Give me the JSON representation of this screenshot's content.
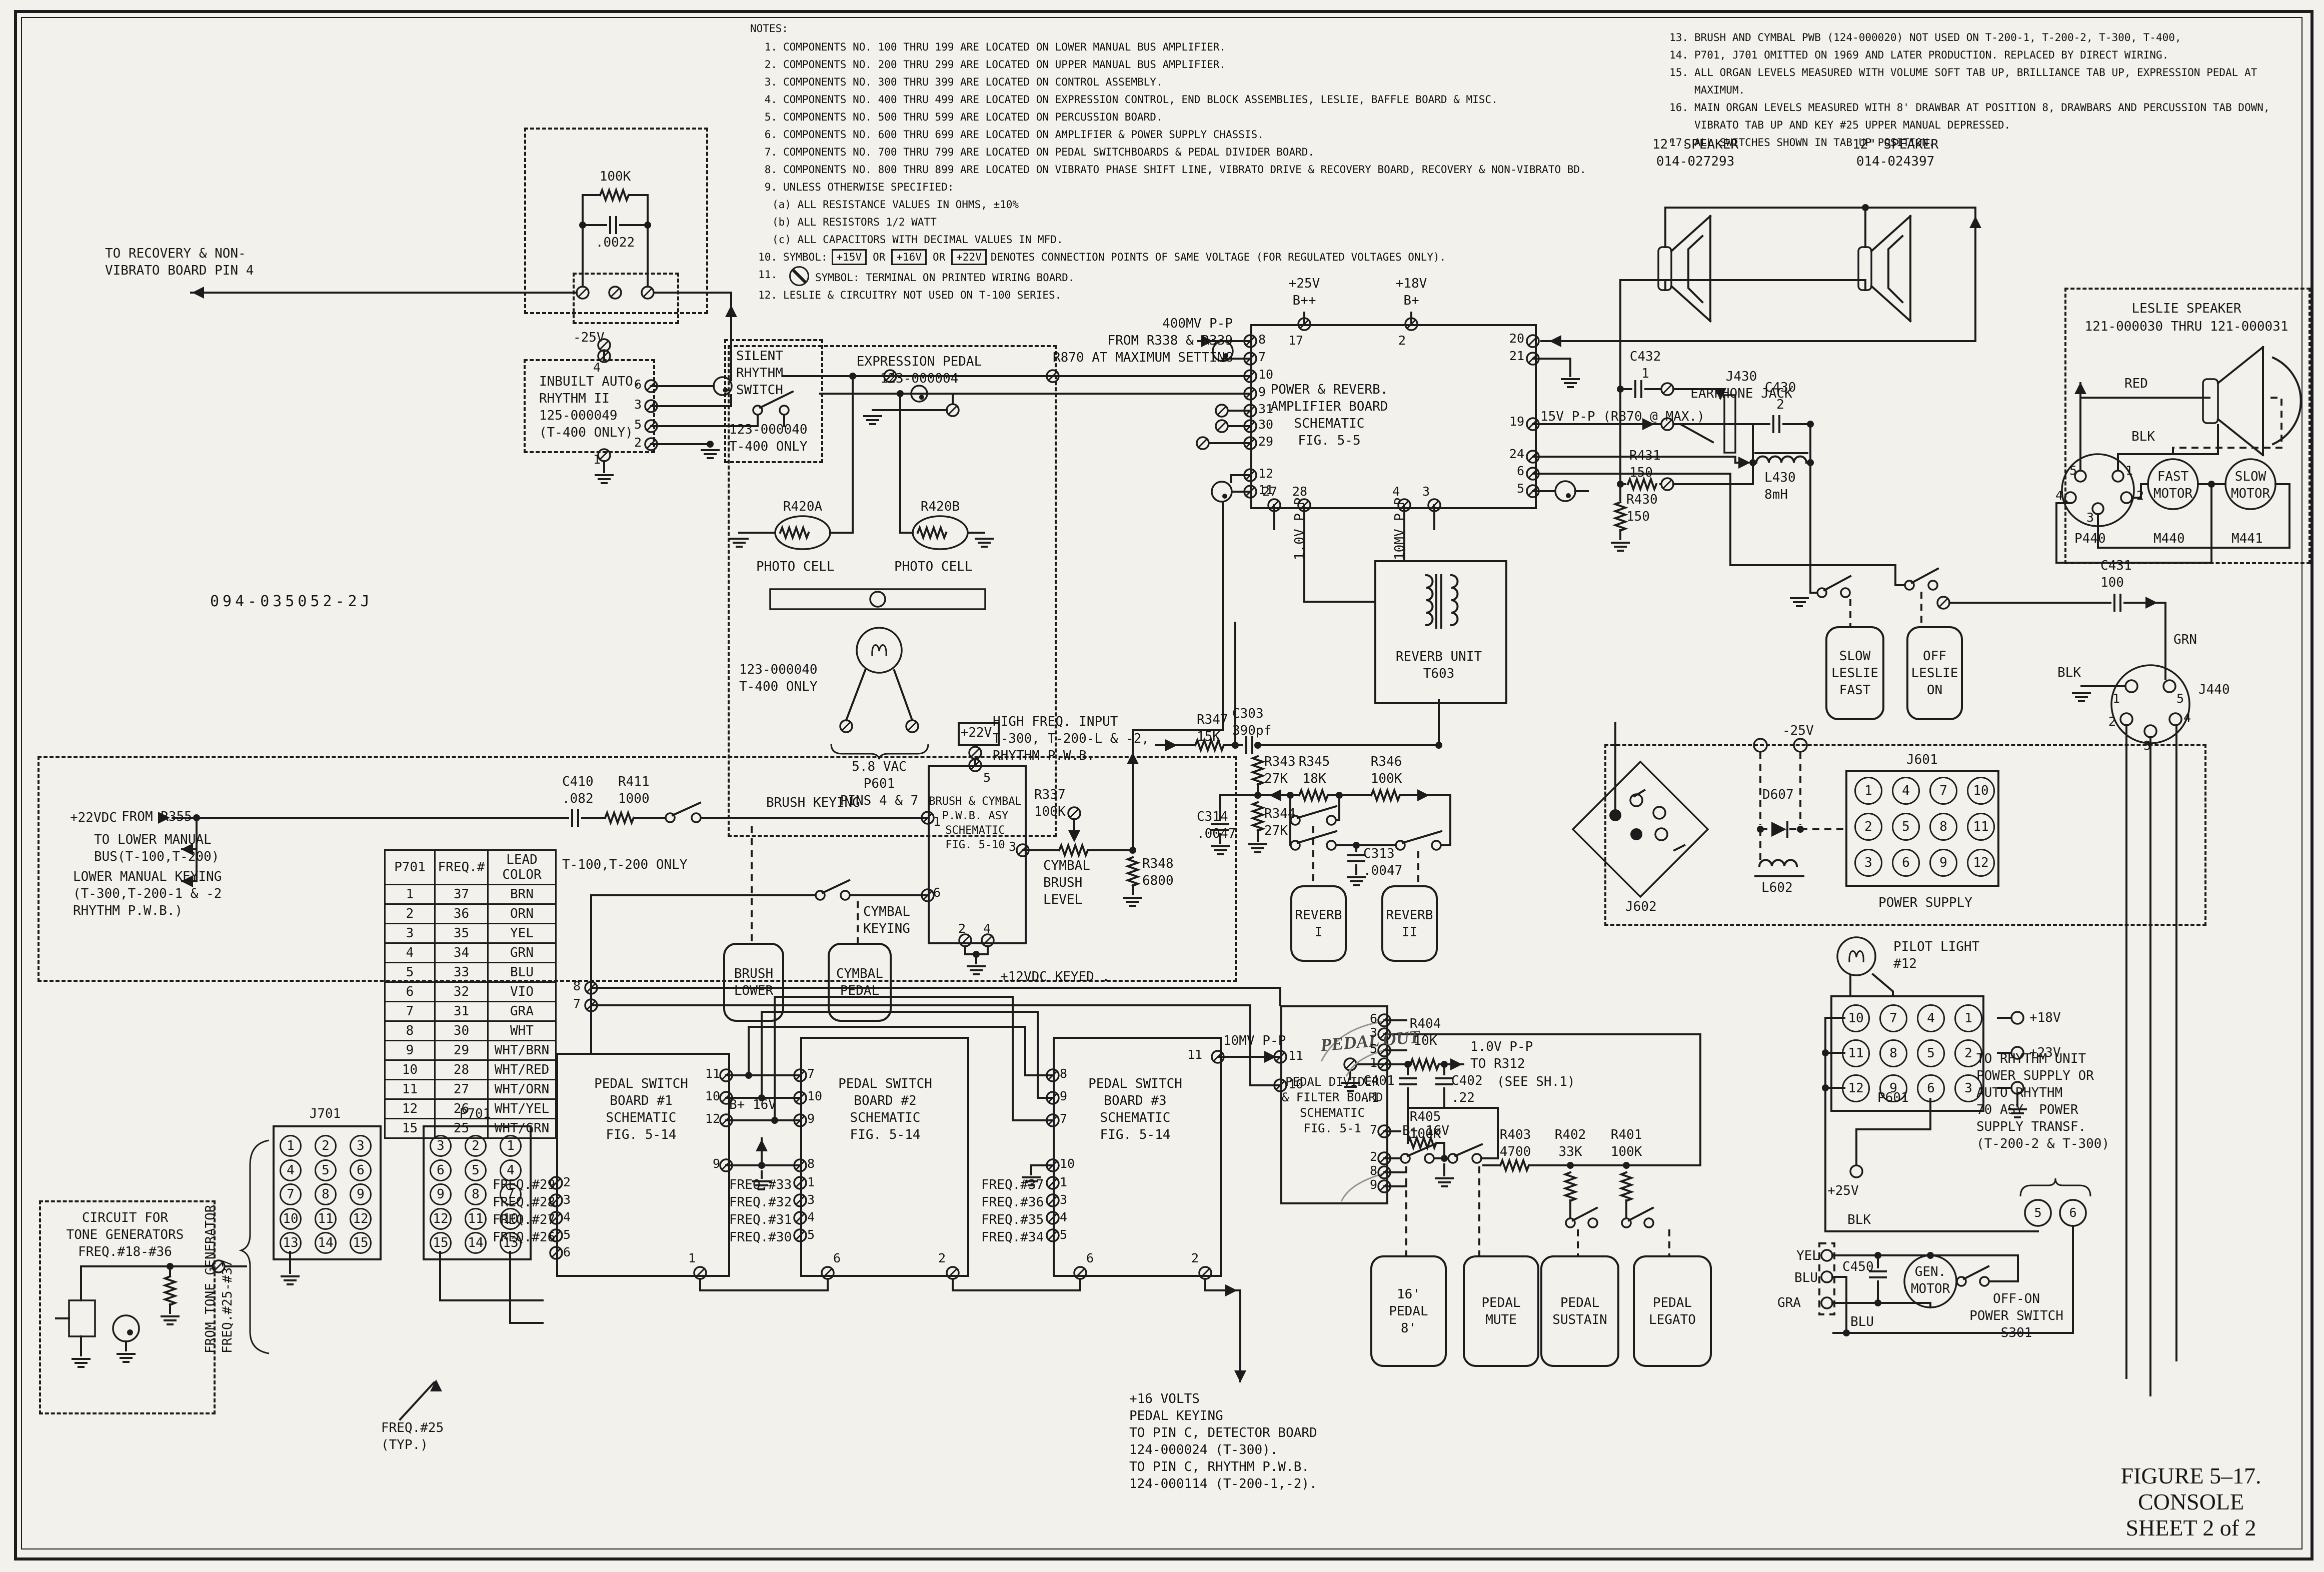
{
  "title_block": {
    "figure": "FIGURE 5–17.",
    "name": "CONSOLE",
    "sheet": "SHEET 2 of 2"
  },
  "drawing_number": "094-035052-2J",
  "notes": {
    "heading": "NOTES:",
    "left": [
      {
        "n": "1.",
        "t": "COMPONENTS NO. 100 THRU 199 ARE LOCATED ON LOWER MANUAL BUS AMPLIFIER."
      },
      {
        "n": "2.",
        "t": "COMPONENTS NO. 200 THRU 299 ARE LOCATED ON UPPER MANUAL BUS AMPLIFIER."
      },
      {
        "n": "3.",
        "t": "COMPONENTS NO. 300 THRU 399 ARE LOCATED ON CONTROL ASSEMBLY."
      },
      {
        "n": "4.",
        "t": "COMPONENTS NO. 400 THRU 499 ARE LOCATED ON EXPRESSION CONTROL, END BLOCK ASSEMBLIES, LESLIE, BAFFLE BOARD & MISC."
      },
      {
        "n": "5.",
        "t": "COMPONENTS NO. 500 THRU 599 ARE LOCATED ON PERCUSSION BOARD."
      },
      {
        "n": "6.",
        "t": "COMPONENTS NO. 600 THRU 699 ARE LOCATED ON AMPLIFIER & POWER SUPPLY CHASSIS."
      },
      {
        "n": "7.",
        "t": "COMPONENTS NO. 700 THRU 799 ARE LOCATED ON PEDAL SWITCHBOARDS & PEDAL DIVIDER BOARD."
      },
      {
        "n": "8.",
        "t": "COMPONENTS NO. 800 THRU 899 ARE LOCATED ON VIBRATO PHASE SHIFT LINE, VIBRATO DRIVE & RECOVERY BOARD, RECOVERY & NON-VIBRATO BD."
      },
      {
        "n": "9.",
        "t": "UNLESS OTHERWISE SPECIFIED:",
        "subs": [
          "(a) ALL RESISTANCE VALUES IN OHMS, ±10%",
          "(b) ALL RESISTORS 1/2 WATT",
          "(c) ALL CAPACITORS WITH DECIMAL VALUES IN MFD."
        ]
      },
      {
        "n": "10.",
        "t": "SYMBOL:",
        "boxed": [
          "+15V",
          "+16V",
          "+22V"
        ],
        "sep": "OR",
        "post": "DENOTES CONNECTION POINTS OF SAME VOLTAGE (FOR REGULATED VOLTAGES ONLY)."
      },
      {
        "n": "11.",
        "sym": true,
        "post": "SYMBOL: TERMINAL ON PRINTED WIRING BOARD."
      },
      {
        "n": "12.",
        "t": "LESLIE & CIRCUITRY NOT USED ON T-100 SERIES."
      }
    ],
    "right": [
      {
        "n": "13.",
        "t": "BRUSH AND CYMBAL PWB (124-000020) NOT USED ON T-200-1, T-200-2, T-300, T-400,"
      },
      {
        "n": "14.",
        "t": "P701, J701 OMITTED ON 1969 AND LATER PRODUCTION.  REPLACED BY DIRECT WIRING."
      },
      {
        "n": "15.",
        "t": "ALL ORGAN LEVELS MEASURED WITH VOLUME SOFT TAB UP, BRILLIANCE TAB UP, EXPRESSION PEDAL AT MAXIMUM."
      },
      {
        "n": "16.",
        "t": "MAIN ORGAN LEVELS MEASURED WITH 8' DRAWBAR AT POSITION 8, DRAWBARS AND PERCUSSION TAB DOWN,\nVIBRATO TAB UP AND KEY #25 UPPER MANUAL DEPRESSED."
      },
      {
        "n": "17.",
        "t": "ALL SWITCHES SHOWN IN TAB UP POSITION."
      }
    ]
  },
  "freq_table": {
    "headers": [
      "P701",
      "FREQ.#",
      "LEAD\nCOLOR"
    ],
    "rows": [
      [
        "1",
        "37",
        "BRN"
      ],
      [
        "2",
        "36",
        "ORN"
      ],
      [
        "3",
        "35",
        "YEL"
      ],
      [
        "4",
        "34",
        "GRN"
      ],
      [
        "5",
        "33",
        "BLU"
      ],
      [
        "6",
        "32",
        "VIO"
      ],
      [
        "7",
        "31",
        "GRA"
      ],
      [
        "8",
        "30",
        "WHT"
      ],
      [
        "9",
        "29",
        "WHT/BRN"
      ],
      [
        "10",
        "28",
        "WHT/RED"
      ],
      [
        "11",
        "27",
        "WHT/ORN"
      ],
      [
        "12",
        "26",
        "WHT/YEL"
      ],
      [
        "15",
        "25",
        "WHT/GRN"
      ]
    ]
  },
  "connectors": {
    "j701": {
      "rows": [
        [
          "1",
          "2",
          "3"
        ],
        [
          "4",
          "5",
          "6"
        ],
        [
          "7",
          "8",
          "9"
        ],
        [
          "10",
          "11",
          "12"
        ],
        [
          "13",
          "14",
          "15"
        ]
      ]
    },
    "p701": {
      "rows": [
        [
          "3",
          "2",
          "1"
        ],
        [
          "6",
          "5",
          "4"
        ],
        [
          "9",
          "8",
          "7"
        ],
        [
          "12",
          "11",
          "10"
        ],
        [
          "15",
          "14",
          "13"
        ]
      ]
    },
    "j601": {
      "rows": [
        [
          "1",
          "4",
          "7",
          "10"
        ],
        [
          "2",
          "5",
          "8",
          "11"
        ],
        [
          "3",
          "6",
          "9",
          "12"
        ]
      ]
    },
    "p601": {
      "rows": [
        [
          "10",
          "7",
          "4",
          "1"
        ],
        [
          "11",
          "8",
          "5",
          "2"
        ],
        [
          "12",
          "9",
          "6",
          "3"
        ]
      ]
    }
  },
  "labels": {
    "sp1": "12\" SPEAKER\n014-027293",
    "sp2": "12\" SPEAKER\n014-024397",
    "leslie1": "LESLIE SPEAKER",
    "leslie2": "121-000030 THRU 121-000031",
    "red": "RED",
    "blk_a": "BLK",
    "p440": "P440",
    "m440": "M440",
    "m441": "M441",
    "fastm": "FAST\nMOTOR",
    "slowm": "SLOW\nMOTOR",
    "r100k": "100K",
    "c0022": ".0022",
    "torec": "TO RECOVERY & NON-\nVIBRATO BOARD PIN 4",
    "n25a": "-25V",
    "inbuilt": "INBUILT AUTO.\nRHYTHM II\n125-000049\n(T-400 ONLY)",
    "silent": "SILENT\nRHYTHM\nSWITCH",
    "silentpn": "123-000040\nT-400 ONLY",
    "expr": "EXPRESSION PEDAL\n123-000004",
    "r420a": "R420A",
    "r420b": "R420B",
    "pc1": "PHOTO CELL",
    "pc2": "PHOTO CELL",
    "exppn": "123-000040\nT-400 ONLY",
    "vac": "5.8 VAC\nP601\nPINS 4 & 7",
    "dwg": "094-035052-2J",
    "mv400": "400MV P-P\nFROM R338 & R339\nR870 AT MAXIMUM SETTING",
    "b1": "+25V\nB++",
    "b2": "+18V\nB+",
    "pamp": "POWER & REVERB.\nAMPLIFIER BOARD\nSCHEMATIC\nFIG. 5-5",
    "v15": "15V P-P (R870 @ MAX.)",
    "c432": "C432\n1",
    "j430": "J430\nEARPHONE JACK",
    "c430": "C430\n2",
    "r431": "R431\n150",
    "r430": "R430\n150",
    "l430": "L430\n8mH",
    "hfi": "HIGH FREQ. INPUT\nT-300, T-200-L & -2,\nRHYTHM P.W.B.",
    "r347": "R347\n15K",
    "c303": "C303\n390pf",
    "r343": "R343\n27K",
    "c314": "C314\n.0047",
    "r344": "R344\n27K",
    "r345": "R345\n18K",
    "r346": "R346\n100K",
    "c313": "C313\n.0047",
    "rev1": "REVERB\nI",
    "rev2": "REVERB\nII",
    "revu": "REVERB UNIT\nT603",
    "v10a": "1.0V P-P",
    "v10b": "10MV P-P",
    "slowl": "SLOW\nLESLIE\nFAST",
    "offl": "OFF\nLESLIE\nON",
    "c431": "C431\n100",
    "grn": "GRN",
    "blk_b": "BLK",
    "j440": "J440",
    "n25b": "-25V",
    "j602": "J602",
    "d607": "D607",
    "l602": "L602",
    "j601": "J601",
    "psup": "POWER SUPPLY",
    "pilot": "PILOT LIGHT\n#12",
    "p601": "P601",
    "p18": "+18V",
    "p23": "+23V",
    "p25": "+25V",
    "torhy": "TO RHYTHM UNIT\nPOWER SUPPLY OR\nAUTO RHYTHM\n70 ASY  POWER\nSUPPLY TRANSF.\n(T-200-2 & T-300)",
    "blk_c": "BLK",
    "yel": "YEL",
    "blu_a": "BLU",
    "gra": "GRA",
    "blu_b": "BLU",
    "c450": "C450",
    "genm": "GEN.\nMOTOR",
    "offon": "OFF-ON\nPOWER SWITCH\nS301",
    "p22vdc": "+22VDC",
    "fr355": "FROM R355",
    "tolm": "TO LOWER MANUAL\nBUS(T-100,T-200)",
    "lmk": "LOWER MANUAL KEYING\n(T-300,T-200-1 & -2\nRHYTHM P.W.B.)",
    "c410": "C410\n.082",
    "r411": "R411\n1000",
    "bkey": "BRUSH KEYING",
    "t100": "T-100,T-200 ONLY",
    "bc": "BRUSH & CYMBAL\nP.W.B. ASY\nSCHEMATIC\nFIG. 5-10",
    "v22box": "+22V",
    "blower": "BRUSH\nLOWER",
    "cpedal": "CYMBAL\nPEDAL",
    "ckey": "CYMBAL\nKEYING",
    "r337": "R337\n100K",
    "cbl": "CYMBAL\nBRUSH\nLEVEL",
    "r348": "R348\n6800",
    "v12k": "+12VDC KEYED .",
    "psb1": "PEDAL SWITCH\nBOARD #1\nSCHEMATIC\nFIG. 5-14",
    "psb2": "PEDAL SWITCH\nBOARD #2\nSCHEMATIC\nFIG. 5-14",
    "psb3": "PEDAL SWITCH\nBOARD #3\nSCHEMATIC\nFIG. 5-14",
    "b16a": "B+ 16V",
    "b16b": "B+ 16V",
    "mv10": "10MV P-P",
    "pdiv": "PEDAL DIVIDER\n& FILTER BOARD\nSCHEMATIC\nFIG. 5-1",
    "pout": "PEDAL OUT",
    "r404": "R404\n10K",
    "v1r312": "1.0V P-P\nTO R312",
    "sh1": "(SEE SH.1)",
    "c401": "C401\n.1",
    "c402": "C402\n.22",
    "r405": "R405\n100K",
    "p16b": "16'\nPEDAL\n8'",
    "pmute": "PEDAL\nMUTE",
    "r403": "R403\n4700",
    "r402": "R402\n33K",
    "r401": "R401\n100K",
    "psus": "PEDAL\nSUSTAIN",
    "pleg": "PEDAL\nLEGATO",
    "v16n": "+16 VOLTS\nPEDAL KEYING\nTO PIN C, DETECTOR BOARD\n124-000024 (T-300).\nTO PIN C, RHYTHM P.W.B.\n124-000114 (T-200-1,-2).",
    "ctg": "CIRCUIT FOR\nTONE GENERATORS\nFREQ.#18-#36",
    "ftg": "FROM TONE GENERATOR\nFREQ.#25-#37",
    "f25t": "FREQ.#25\n(TYP.)",
    "j701": "J701",
    "p701g": "P701",
    "f29": "FREQ.#29",
    "f28": "FREQ.#28",
    "f27": "FREQ.#27",
    "f26": "FREQ.#26",
    "f33": "FREQ.#33",
    "f32": "FREQ.#32",
    "f31": "FREQ.#31",
    "f30": "FREQ.#30",
    "f37": "FREQ.#37",
    "f36": "FREQ.#36",
    "f35": "FREQ.#35",
    "f34": "FREQ.#34"
  },
  "pins": [
    [
      "8",
      2516,
      666,
      2500,
      682
    ],
    [
      "7",
      2516,
      701,
      2500,
      717
    ],
    [
      "10",
      2516,
      736,
      2500,
      752
    ],
    [
      "9",
      2516,
      771,
      2500,
      787
    ],
    [
      "31",
      2516,
      805,
      2500,
      821
    ],
    [
      "30",
      2516,
      836,
      2500,
      852
    ],
    [
      "29",
      2516,
      870,
      2500,
      886
    ],
    [
      "12",
      2516,
      934,
      2500,
      950
    ],
    [
      "11",
      2516,
      967,
      2500,
      983
    ],
    [
      "17",
      2576,
      668,
      2608,
      648
    ],
    [
      "2",
      2796,
      668,
      2822,
      648
    ],
    [
      "20",
      3048,
      664,
      3065,
      682,
      "r"
    ],
    [
      "21",
      3048,
      699,
      3065,
      717,
      "r"
    ],
    [
      "19",
      3048,
      830,
      3065,
      848,
      "r"
    ],
    [
      "24",
      3048,
      895,
      3065,
      913,
      "r"
    ],
    [
      "6",
      3048,
      929,
      3065,
      947,
      "r"
    ],
    [
      "5",
      3048,
      964,
      3065,
      982,
      "r"
    ],
    [
      "27",
      2524,
      970,
      2548,
      1010
    ],
    [
      "28",
      2584,
      970,
      2608,
      1010
    ],
    [
      "4",
      2784,
      970,
      2808,
      1010
    ],
    [
      "3",
      2844,
      970,
      2868,
      1010
    ],
    [
      "4",
      1186,
      722,
      1208,
      712
    ],
    [
      "6",
      1268,
      756,
      1302,
      772
    ],
    [
      "3",
      1268,
      796,
      1302,
      812
    ],
    [
      "5",
      1268,
      836,
      1302,
      852
    ],
    [
      "2",
      1268,
      872,
      1302,
      888
    ],
    [
      "1",
      1186,
      906,
      1208,
      910
    ],
    [
      "11",
      2576,
      2098,
      2560,
      2113
    ],
    [
      "10",
      2576,
      2155,
      2560,
      2170
    ],
    [
      "6",
      2754,
      2024,
      2768,
      2040,
      "r"
    ],
    [
      "3",
      2754,
      2052,
      2768,
      2068,
      "r"
    ],
    [
      "5",
      2754,
      2084,
      2768,
      2100,
      "r"
    ],
    [
      "1",
      2754,
      2112,
      2768,
      2128,
      "r"
    ],
    [
      "7",
      2754,
      2246,
      2768,
      2262,
      "r"
    ],
    [
      "2",
      2754,
      2300,
      2768,
      2316,
      "r"
    ],
    [
      "8",
      2754,
      2328,
      2768,
      2344,
      "r"
    ],
    [
      "9",
      2754,
      2356,
      2768,
      2372,
      "r"
    ],
    [
      "8",
      1146,
      1959,
      1182,
      1975
    ],
    [
      "7",
      1146,
      1994,
      1182,
      2010
    ],
    [
      "11",
      1440,
      2134,
      1452,
      2150,
      "r"
    ],
    [
      "10",
      1440,
      2179,
      1452,
      2195,
      "r"
    ],
    [
      "12",
      1440,
      2224,
      1452,
      2240,
      "r"
    ],
    [
      "9",
      1440,
      2314,
      1452,
      2330,
      "r"
    ],
    [
      "2",
      1126,
      2351,
      1112,
      2365
    ],
    [
      "3",
      1126,
      2386,
      1112,
      2400
    ],
    [
      "4",
      1126,
      2421,
      1112,
      2435
    ],
    [
      "5",
      1126,
      2456,
      1112,
      2470
    ],
    [
      "6",
      1126,
      2491,
      1112,
      2505
    ],
    [
      "1",
      1376,
      2503,
      1400,
      2545
    ],
    [
      "7",
      1614,
      2134,
      1600,
      2150
    ],
    [
      "10",
      1614,
      2179,
      1600,
      2195
    ],
    [
      "9",
      1614,
      2224,
      1600,
      2240
    ],
    [
      "8",
      1614,
      2314,
      1600,
      2330
    ],
    [
      "1",
      1614,
      2351,
      1600,
      2365
    ],
    [
      "3",
      1614,
      2386,
      1600,
      2400
    ],
    [
      "4",
      1614,
      2421,
      1600,
      2435
    ],
    [
      "5",
      1614,
      2456,
      1600,
      2470
    ],
    [
      "6",
      1666,
      2503,
      1655,
      2545
    ],
    [
      "2",
      1876,
      2503,
      1905,
      2545
    ],
    [
      "8",
      2119,
      2134,
      2105,
      2150
    ],
    [
      "9",
      2119,
      2179,
      2105,
      2195
    ],
    [
      "7",
      2119,
      2224,
      2105,
      2240
    ],
    [
      "10",
      2119,
      2314,
      2105,
      2330
    ],
    [
      "1",
      2119,
      2351,
      2105,
      2365
    ],
    [
      "3",
      2119,
      2386,
      2105,
      2400
    ],
    [
      "4",
      2119,
      2421,
      2105,
      2435
    ],
    [
      "5",
      2119,
      2456,
      2105,
      2470
    ],
    [
      "6",
      2172,
      2503,
      2160,
      2545
    ],
    [
      "2",
      2382,
      2503,
      2410,
      2545
    ],
    [
      "11",
      2404,
      2096,
      2435,
      2113,
      "r"
    ],
    [
      "5",
      1966,
      1542,
      1950,
      1530
    ],
    [
      "1",
      1866,
      1630,
      1855,
      1635
    ],
    [
      "6",
      1866,
      1772,
      1855,
      1790
    ],
    [
      "3",
      2032,
      1680,
      2045,
      1700,
      "r"
    ],
    [
      "2",
      1916,
      1844,
      1930,
      1880
    ],
    [
      "4",
      1966,
      1844,
      1975,
      1880
    ],
    [
      "5",
      4138,
      928,
      null,
      null
    ],
    [
      "1",
      4250,
      928,
      null,
      null
    ],
    [
      "4",
      4110,
      978,
      null,
      null
    ],
    [
      "2",
      4272,
      978,
      null,
      null
    ],
    [
      "3",
      4172,
      1022,
      null,
      null
    ],
    [
      "1",
      4224,
      1384,
      null,
      null
    ],
    [
      "5",
      4352,
      1384,
      null,
      null
    ],
    [
      "2",
      4216,
      1430,
      null,
      null
    ],
    [
      "3",
      4286,
      1478,
      null,
      null
    ],
    [
      "4",
      4366,
      1422,
      null,
      null
    ],
    [
      "5",
      4075,
      2412,
      null,
      null,
      "c"
    ],
    [
      "6",
      4145,
      2412,
      null,
      null,
      "c"
    ]
  ]
}
